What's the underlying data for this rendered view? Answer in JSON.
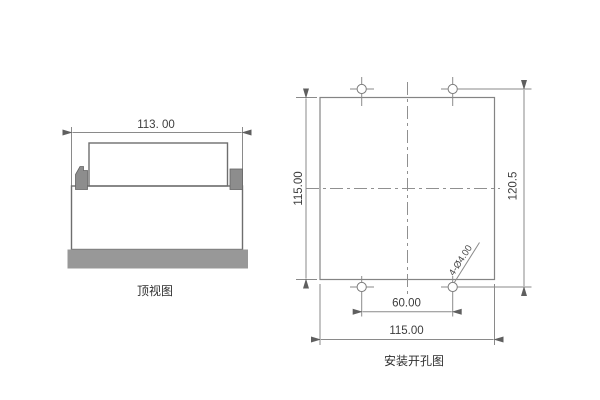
{
  "page": {
    "background": "#ffffff"
  },
  "colors": {
    "drawing_edge": "#6e6e6e",
    "dimension_line": "#8a8a8a",
    "center_line": "#909090",
    "gray_fill": "#8d8d8d",
    "base_bar_fill": "#989898",
    "text": "#3d3d3d"
  },
  "top_view": {
    "caption": "顶视图",
    "dims": {
      "width": "113. 00"
    }
  },
  "mounting_view": {
    "caption": "安装开孔图",
    "dims": {
      "panel_height": "115.00",
      "hole_row_spacing": "120.5",
      "hole_col_spacing": "60.00",
      "panel_width": "115.00",
      "hole_callout": "4-Ø4.00"
    }
  }
}
